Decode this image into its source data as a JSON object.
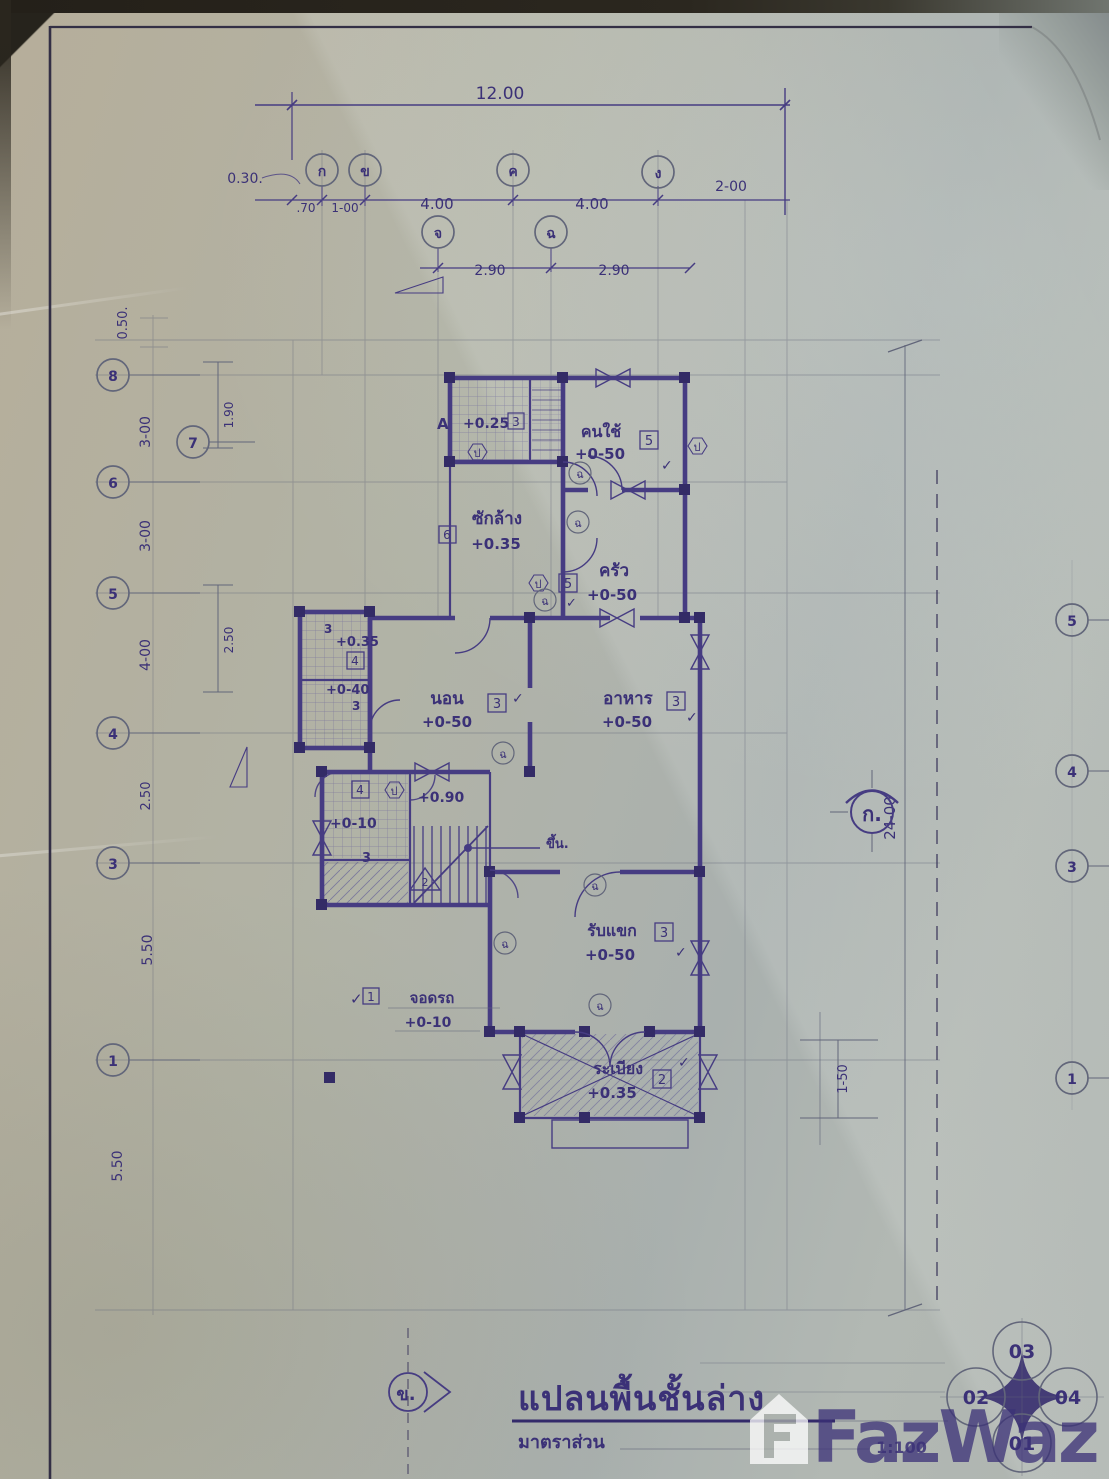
{
  "title": {
    "plan": "แปลนพื้นชั้นล่าง",
    "scale_label": "มาตราส่วน",
    "scale_value": "1:100",
    "section_marker": "ข."
  },
  "watermark": {
    "text": "FazWaz"
  },
  "grid": {
    "top_main": [
      "ก",
      "ข",
      "ค",
      "ง"
    ],
    "top_mid": [
      "จ",
      "ฉ"
    ],
    "left": [
      "8",
      "7",
      "6",
      "5",
      "4",
      "3",
      "1"
    ],
    "right": [
      "5",
      "4",
      "3",
      "1"
    ]
  },
  "dims": {
    "top_total": "12.00",
    "offset_030": "0.30.",
    "seg_70": ".70",
    "seg_100": "1-00",
    "seg_400a": "4.00",
    "seg_400b": "4.00",
    "seg_200": "2-00",
    "seg_290a": "2.90",
    "seg_290b": "2.90",
    "left_050": "0.50.",
    "left_300a": "3-00",
    "left_300b": "3-00",
    "left_400": "4-00",
    "left_250": "2.50",
    "left_550a": "5.50",
    "left_550b": "5.50",
    "off_190": "1.90",
    "off_250": "2.50",
    "right_2400": "24-00",
    "right_150": "1-50"
  },
  "rooms": {
    "bath_top": {
      "ref": "A",
      "level": "+0.25",
      "tag": "3"
    },
    "maid": {
      "name": "คนใช้",
      "level": "+0-50",
      "tag": "5"
    },
    "laundry": {
      "name": "ซักล้าง",
      "level": "+0.35",
      "tag": "6"
    },
    "kitchen": {
      "name": "ครัว",
      "level": "+0-50",
      "tag": "5"
    },
    "bath_left": {
      "tag_a": "3",
      "level_a": "+0.35",
      "tag_b": "4",
      "level_b": "+0-40",
      "tag_c": "3"
    },
    "bedroom": {
      "name": "นอน",
      "level": "+0-50",
      "tag": "3"
    },
    "dining": {
      "name": "อาหาร",
      "level": "+0-50",
      "tag": "3"
    },
    "wc": {
      "tag": "4",
      "level": "+0.90"
    },
    "entry": {
      "level": "+0-10"
    },
    "stair": {
      "up": "ขึ้น.",
      "tag": "3",
      "section": "2"
    },
    "living": {
      "name": "รับแขก",
      "level": "+0-50",
      "tag": "3"
    },
    "carport": {
      "name": "จอดรถ",
      "level": "+0-10",
      "tag": "1"
    },
    "porch": {
      "name": "ระเบียง",
      "level": "+0.35",
      "tag": "2"
    }
  },
  "markers": {
    "north": "ก.",
    "window_tag": "ป",
    "door_tag": "ฉ",
    "check": "✓"
  },
  "sheet": {
    "circles": [
      "03",
      "02",
      "04",
      "01"
    ]
  }
}
